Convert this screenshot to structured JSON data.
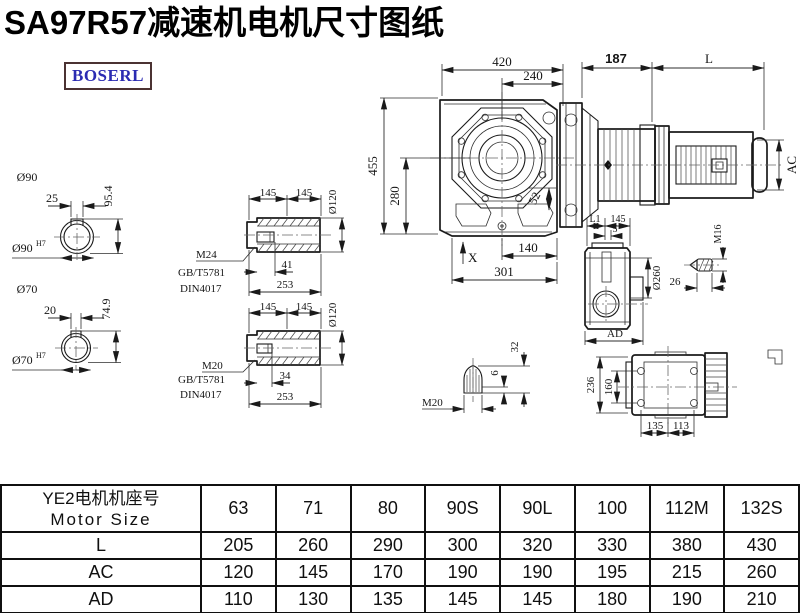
{
  "title": "SA97R57减速机电机尺寸图纸",
  "logo": "BOSERL",
  "front_view": {
    "w420": "420",
    "w240": "240",
    "h455": "455",
    "h280": "280",
    "d52": "52",
    "w140": "140",
    "w301": "301",
    "x_mark": "X"
  },
  "motor_view": {
    "d187": "187",
    "dl": "L",
    "dac": "AC"
  },
  "shaft_90": {
    "dia": "Ø90",
    "key_w": "25",
    "depth": "95.4",
    "bore": "Ø90",
    "tol": "H7"
  },
  "shaft_70": {
    "dia": "Ø70",
    "key_w": "20",
    "depth": "74.9",
    "bore": "Ø70",
    "tol": "H7"
  },
  "hollow_shaft_a": {
    "seg1": "145",
    "seg2": "145",
    "dia": "Ø120",
    "thread": "M24",
    "std_gb": "GB/T5781",
    "std_din": "DIN4017",
    "plug": "41",
    "len": "253"
  },
  "hollow_shaft_b": {
    "seg1": "145",
    "seg2": "145",
    "dia": "Ø120",
    "thread": "M20",
    "std_gb": "GB/T5781",
    "std_din": "DIN4017",
    "plug": "34",
    "len": "253"
  },
  "side_view": {
    "l1": "L1",
    "w145": "145",
    "w5": "5",
    "dia": "Ø260",
    "ad": "AD"
  },
  "plug_bolt": {
    "thread": "M16",
    "len": "26"
  },
  "cone": {
    "thread": "M20",
    "h6": "6",
    "h32": "32"
  },
  "top_view": {
    "h236": "236",
    "h160": "160",
    "w135": "135",
    "w113": "113"
  },
  "table": {
    "header_cn": "YE2电机机座号",
    "header_en": "Motor Size",
    "columns": [
      "63",
      "71",
      "80",
      "90S",
      "90L",
      "100",
      "112M",
      "132S"
    ],
    "rows": [
      {
        "label": "L",
        "values": [
          "205",
          "260",
          "290",
          "300",
          "320",
          "330",
          "380",
          "430"
        ]
      },
      {
        "label": "AC",
        "values": [
          "120",
          "145",
          "170",
          "190",
          "190",
          "195",
          "215",
          "260"
        ]
      },
      {
        "label": "AD",
        "values": [
          "110",
          "130",
          "135",
          "145",
          "145",
          "180",
          "190",
          "210"
        ]
      }
    ]
  }
}
